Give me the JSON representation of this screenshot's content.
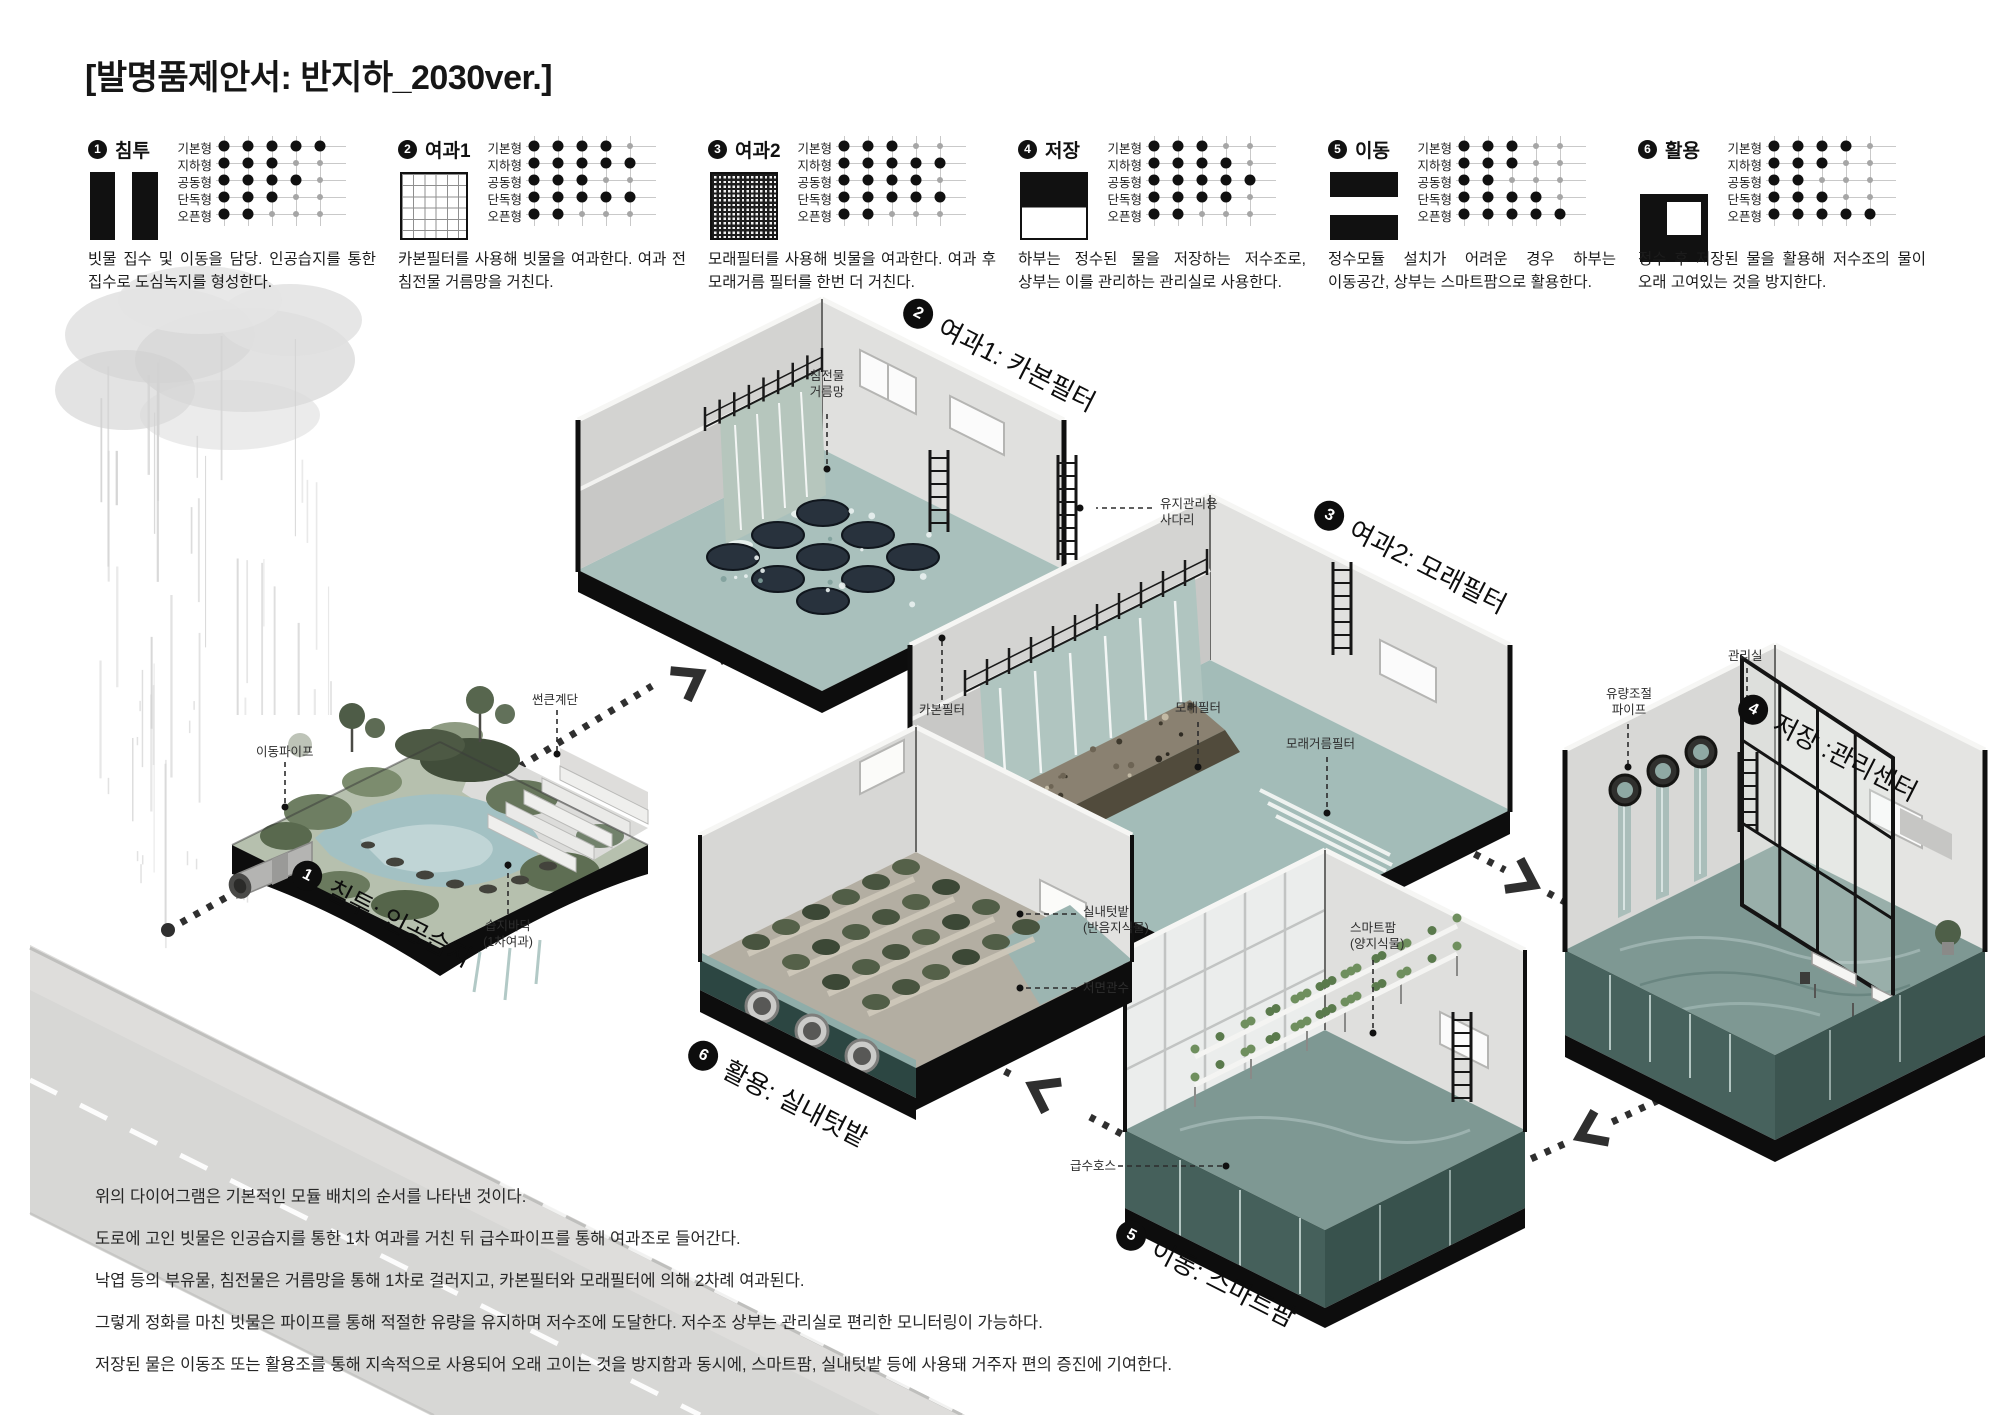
{
  "title": "[발명품제안서: 반지하_2030ver.]",
  "legend": {
    "row_labels": [
      "기본형",
      "지하형",
      "공동형",
      "단독형",
      "오픈형"
    ],
    "items": [
      {
        "num": "1",
        "name": "침투",
        "icon": "vertical-slot",
        "desc": "빗물 집수 및 이동을 담당. 인공습지를 통한 집수로 도심녹지를 형성한다.",
        "dots": [
          5,
          3,
          4,
          3,
          2
        ]
      },
      {
        "num": "2",
        "name": "여과1",
        "icon": "grid",
        "desc": "카본필터를 사용해 빗물을 여과한다. 여과 전 침전물 거름망을 거친다.",
        "dots": [
          4,
          5,
          3,
          5,
          2
        ]
      },
      {
        "num": "3",
        "name": "여과2",
        "icon": "mesh",
        "desc": "모래필터를 사용해 빗물을 여과한다. 여과 후 모래거름 필터를 한번 더 거친다.",
        "dots": [
          3,
          5,
          4,
          5,
          2
        ]
      },
      {
        "num": "4",
        "name": "저장",
        "icon": "half-top",
        "desc": "하부는 정수된 물을 저장하는 저수조로, 상부는 이를 관리하는 관리실로 사용한다.",
        "dots": [
          3,
          4,
          5,
          4,
          2
        ]
      },
      {
        "num": "5",
        "name": "이동",
        "icon": "horizontal-slot",
        "desc": "정수모듈 설치가 어려운 경우 하부는 이동공간, 상부는 스마트팜으로 활용한다.",
        "dots": [
          3,
          3,
          2,
          4,
          5
        ]
      },
      {
        "num": "6",
        "name": "활용",
        "icon": "corner-window",
        "desc": "정수 후 저장된 물을 활용해 저수조의 물이 오래 고여있는 것을 방지한다.",
        "dots": [
          4,
          3,
          2,
          3,
          5
        ]
      }
    ]
  },
  "modules": {
    "m1": {
      "num": "1",
      "label": "침투: 인공습지"
    },
    "m2": {
      "num": "2",
      "label": "여과1: 카본필터"
    },
    "m3": {
      "num": "3",
      "label": "여과2: 모래필터"
    },
    "m4": {
      "num": "4",
      "label": "저장 :관리센터"
    },
    "m5": {
      "num": "5",
      "label": "이동: 스마트팜"
    },
    "m6": {
      "num": "6",
      "label": "활용: 실내텃밭"
    }
  },
  "callouts": {
    "sediment_mesh": "침전물\n거름망",
    "maintenance_ladder": "유지관리용\n사다리",
    "carbon_filter": "카본필터",
    "sand_filter": "모래필터",
    "sand_strain_filter": "모래거름필터",
    "flow_control_pipe": "유량조절\n파이프",
    "management_room": "관리실",
    "transfer_pipe": "이동파이프",
    "sunken_stairs": "썬큰계단",
    "wetland_floor": "습지바닥\n(1차여과)",
    "indoor_garden": "실내텃밭\n(반음지식물)",
    "bottom_watering": "저면관수",
    "smart_farm": "스마트팜\n(양지식물)",
    "water_hose": "급수호스"
  },
  "footer": {
    "lines": [
      "위의 다이어그램은 기본적인 모듈 배치의 순서를 나타낸 것이다.",
      "도로에 고인 빗물은 인공습지를 통한 1차 여과를 거친 뒤 급수파이프를 통해 여과조로 들어간다.",
      "낙엽 등의 부유물, 침전물은 거름망을 통해 1차로 걸러지고, 카본필터와 모래필터에 의해 2차례 여과된다.",
      "그렇게 정화를 마친 빗물은 파이프를 통해 적절한 유량을 유지하며 저수조에 도달한다. 저수조 상부는 관리실로 편리한 모니터링이 가능하다.",
      "저장된 물은 이동조 또는 활용조를 통해 지속적으로 사용되어 오래 고이는 것을 방지함과 동시에, 스마트팜, 실내텃밭 등에 사용돼 거주자 편의 증진에 기여한다."
    ]
  },
  "colors": {
    "ink": "#111111",
    "wall_gray": "#d8d8d6",
    "water_teal": "#a3bcb8",
    "tank_dark_teal": "#45605b",
    "plant_green": "#55624d",
    "sand_brown": "#8a8171",
    "road_gray": "#d7d7d5"
  }
}
